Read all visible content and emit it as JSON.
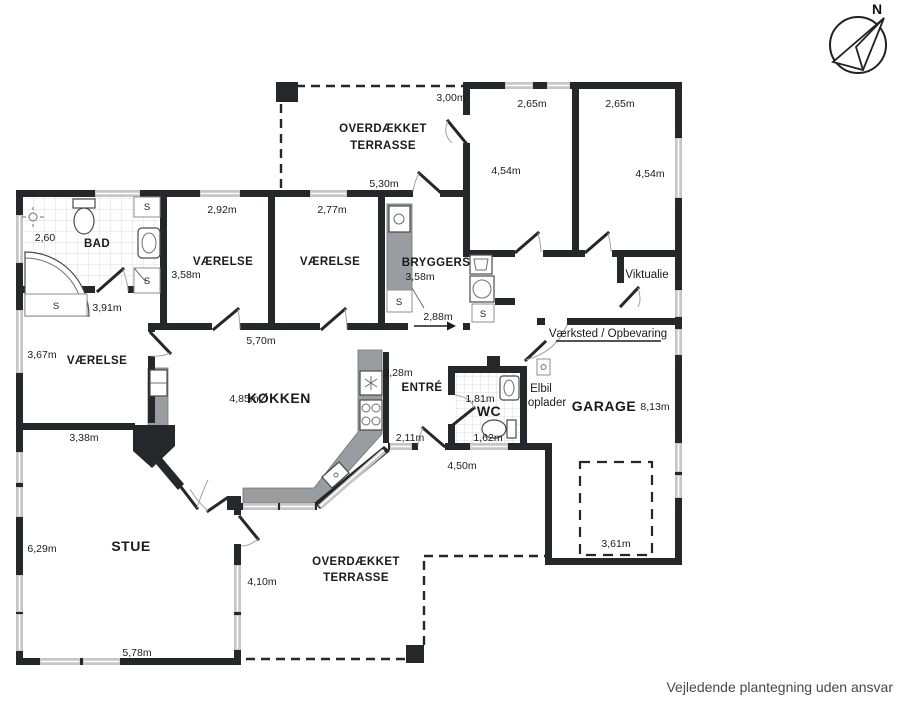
{
  "footer": {
    "disclaimer": "Vejledende plantegning uden ansvar"
  },
  "compass": {
    "north": "N"
  },
  "shared": {
    "closet": "S"
  },
  "terrace_top": {
    "name_line1": "OVERDÆKKET",
    "name_line2": "TERRASSE",
    "dim_width": "3,00m",
    "dim_bottom": "5,30m"
  },
  "bedroom_right_1": {
    "dim_width": "2,65m",
    "dim_height": "4,54m"
  },
  "bedroom_right_2": {
    "dim_width": "2,65m",
    "dim_height": "4,54m"
  },
  "bathroom": {
    "name": "BAD",
    "dim_shower": "2,60",
    "dim_hall": "3,91m"
  },
  "bedroom_1": {
    "name": "VÆRELSE",
    "dim_width": "2,92m",
    "dim_height": "3,58m"
  },
  "bedroom_2": {
    "name": "VÆRELSE",
    "dim_width": "2,77m"
  },
  "utility": {
    "name": "BRYGGERS",
    "dim_height": "3,58m",
    "dim_bottom": "2,88m"
  },
  "pantry": {
    "name": "Viktualie"
  },
  "workshop": {
    "name": "Værksted / Opbevaring"
  },
  "bedroom_3": {
    "name": "VÆRELSE",
    "dim_height": "3,67m",
    "dim_bottom": "3,38m"
  },
  "kitchen": {
    "name": "KØKKEN",
    "dim_width": "4,85m",
    "dim_top": "5,70m"
  },
  "entry": {
    "name": "ENTRÉ",
    "dim_height": "3,28m",
    "dim_door": "2,11m",
    "dim_bottom": "4,50m"
  },
  "wc": {
    "name": "WC",
    "dim_1": "1,81m",
    "dim_2": "1,62m"
  },
  "ev_charger": {
    "line1": "Elbil",
    "line2": "oplader"
  },
  "garage": {
    "name": "GARAGE",
    "dim_length": "8,13m",
    "dim_parking": "3,61m"
  },
  "living": {
    "name": "STUE",
    "dim_height": "6,29m",
    "dim_width": "5,78m",
    "dim_east": "4,10m"
  },
  "terrace_bottom": {
    "name_line1": "OVERDÆKKET",
    "name_line2": "TERRASSE"
  },
  "colors": {
    "wall": "#26272b",
    "window": "#c6c6c6",
    "counter": "#999d9f",
    "text": "#1b1b1d",
    "footer_text": "#45484d"
  }
}
